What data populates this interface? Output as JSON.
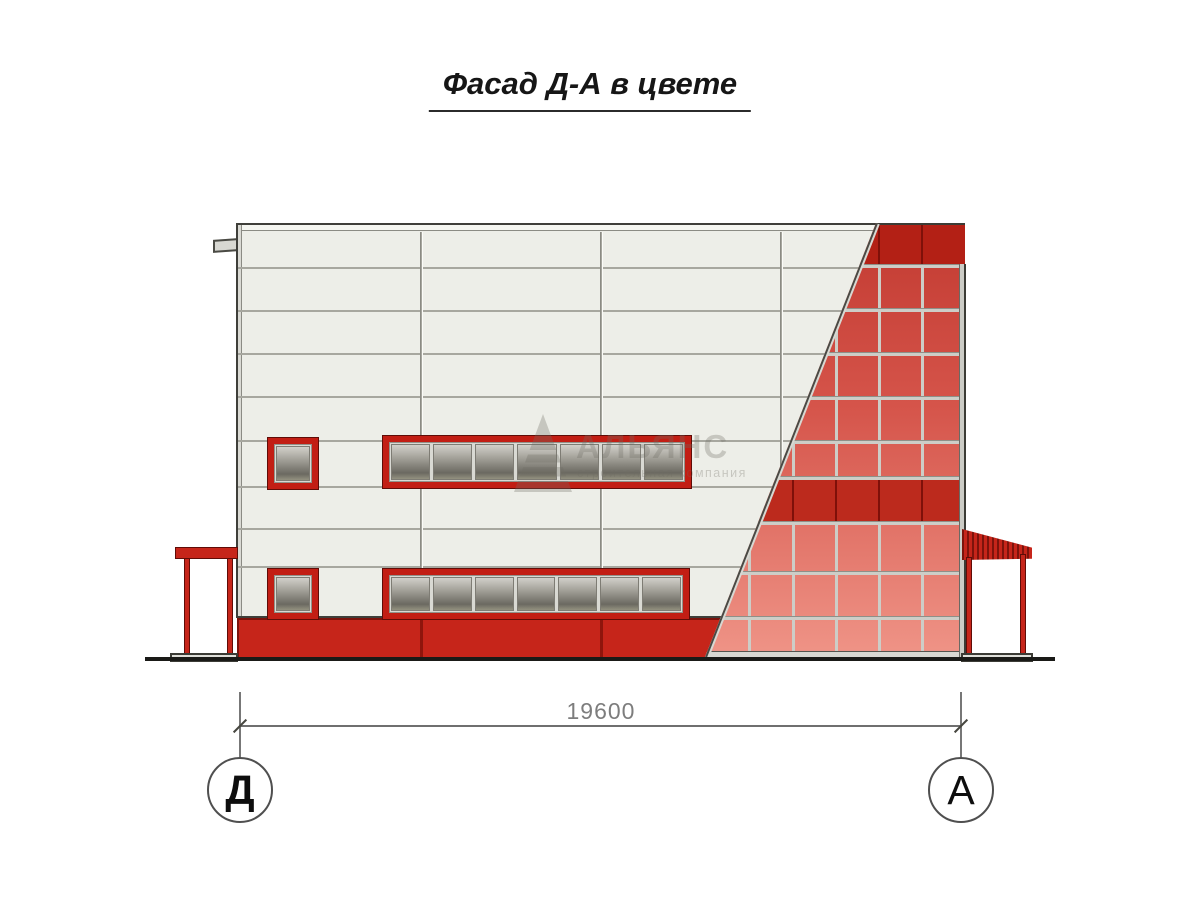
{
  "title": {
    "text": "Фасад Д-А в цвете"
  },
  "drawing": {
    "dimension": {
      "value": "19600"
    },
    "axes": {
      "left": {
        "label": "Д"
      },
      "right": {
        "label": "А"
      }
    },
    "watermark": {
      "name": "АЛЬЯНС",
      "subtitle": "строительная компания"
    },
    "facade": {
      "white_panel_color": "#edeee8",
      "panel_seam_color": "#a7a79f",
      "red_panel_gradient_top": "#c23a31",
      "red_panel_gradient_bottom": "#ef9487",
      "dark_band_color": "#b32015",
      "plinth_color": "#c6251a",
      "window_frame_color": "#c21e14",
      "mullion_color": "#cdcdc7",
      "ground_color": "#1a1a17",
      "upper_ribbon_panes": 7,
      "lower_ribbon_panes": 7,
      "glazing_columns": 6,
      "glazing_rows": 10,
      "dark_band_rows": 2
    }
  }
}
